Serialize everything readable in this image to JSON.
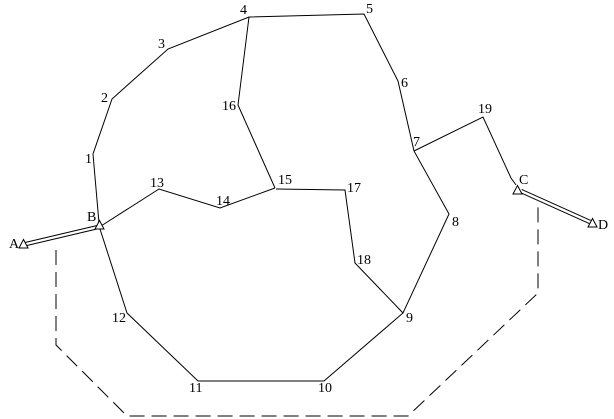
{
  "figure": {
    "description": "Line diagram of a numbered network: a large irregular polygon of nodes 1-12 with internal chords through nodes 13-19, terminal points A, B, C, D marked with small open triangles, double-stroked links A-B and C-D, and a dashed outer boundary.",
    "canvas": {
      "width": 614,
      "height": 419,
      "background": "#ffffff",
      "stroke_color": "#000000"
    },
    "node_labels": [
      {
        "text": "1",
        "x": 85,
        "y": 163
      },
      {
        "text": "2",
        "x": 101,
        "y": 102
      },
      {
        "text": "3",
        "x": 158,
        "y": 48
      },
      {
        "text": "4",
        "x": 240,
        "y": 14
      },
      {
        "text": "5",
        "x": 366,
        "y": 13
      },
      {
        "text": "6",
        "x": 401,
        "y": 87
      },
      {
        "text": "7",
        "x": 413,
        "y": 146
      },
      {
        "text": "8",
        "x": 452,
        "y": 226
      },
      {
        "text": "9",
        "x": 406,
        "y": 322
      },
      {
        "text": "10",
        "x": 318,
        "y": 392
      },
      {
        "text": "11",
        "x": 189,
        "y": 392
      },
      {
        "text": "12",
        "x": 112,
        "y": 322
      },
      {
        "text": "13",
        "x": 150,
        "y": 187
      },
      {
        "text": "14",
        "x": 216,
        "y": 205
      },
      {
        "text": "15",
        "x": 278,
        "y": 184
      },
      {
        "text": "16",
        "x": 222,
        "y": 110
      },
      {
        "text": "17",
        "x": 347,
        "y": 192
      },
      {
        "text": "18",
        "x": 357,
        "y": 264
      },
      {
        "text": "19",
        "x": 478,
        "y": 113
      },
      {
        "text": "A",
        "x": 9,
        "y": 248
      },
      {
        "text": "B",
        "x": 87,
        "y": 221
      },
      {
        "text": "C",
        "x": 519,
        "y": 184
      },
      {
        "text": "D",
        "x": 598,
        "y": 229
      }
    ],
    "solid_paths": [
      {
        "name": "outer-ring-B-1-to-12-B",
        "points": [
          [
            99,
            223
          ],
          [
            93,
            154
          ],
          [
            112,
            99
          ],
          [
            168,
            49
          ],
          [
            249,
            17
          ],
          [
            364,
            14
          ],
          [
            398,
            81
          ],
          [
            414,
            151
          ],
          [
            449,
            214
          ],
          [
            403,
            313
          ],
          [
            324,
            381
          ],
          [
            198,
            381
          ],
          [
            127,
            313
          ],
          [
            100,
            229
          ]
        ]
      },
      {
        "name": "chord-4-16-15",
        "points": [
          [
            249,
            17
          ],
          [
            238,
            105
          ],
          [
            275,
            188
          ]
        ]
      },
      {
        "name": "chord-15-14-13-B",
        "points": [
          [
            275,
            188
          ],
          [
            220,
            208
          ],
          [
            159,
            189
          ],
          [
            101,
            226
          ]
        ]
      },
      {
        "name": "chord-15-17-18-9",
        "points": [
          [
            276,
            189
          ],
          [
            345,
            190
          ],
          [
            355,
            263
          ],
          [
            403,
            313
          ]
        ]
      },
      {
        "name": "chord-7-19-C",
        "points": [
          [
            414,
            151
          ],
          [
            483,
            117
          ],
          [
            511,
            178
          ],
          [
            516,
            185
          ]
        ]
      }
    ],
    "dashed_path": {
      "name": "dashed-outer-boundary",
      "dash": "15 7",
      "points": [
        [
          56,
          250
        ],
        [
          56,
          345
        ],
        [
          127,
          416
        ],
        [
          408,
          416
        ],
        [
          538,
          293
        ],
        [
          538,
          203
        ]
      ]
    },
    "double_links": [
      {
        "name": "double-link-A-B",
        "points": [
          [
            26,
            244
          ],
          [
            98,
            227
          ]
        ],
        "gap": 1.7
      },
      {
        "name": "double-link-C-D",
        "points": [
          [
            521,
            191
          ],
          [
            590,
            222
          ]
        ],
        "gap": 1.7
      }
    ],
    "triangle_markers": [
      {
        "name": "terminal-A-triangle",
        "points": "23.5,239.5 19,248 28,248"
      },
      {
        "name": "terminal-B-triangle",
        "points": "99.5,220.5 95,229 104,229"
      },
      {
        "name": "terminal-C-triangle",
        "points": "517.5,185.5 513,194 522,194"
      },
      {
        "name": "terminal-D-triangle",
        "points": "592.5,218.5 588,227 597,227"
      }
    ]
  }
}
